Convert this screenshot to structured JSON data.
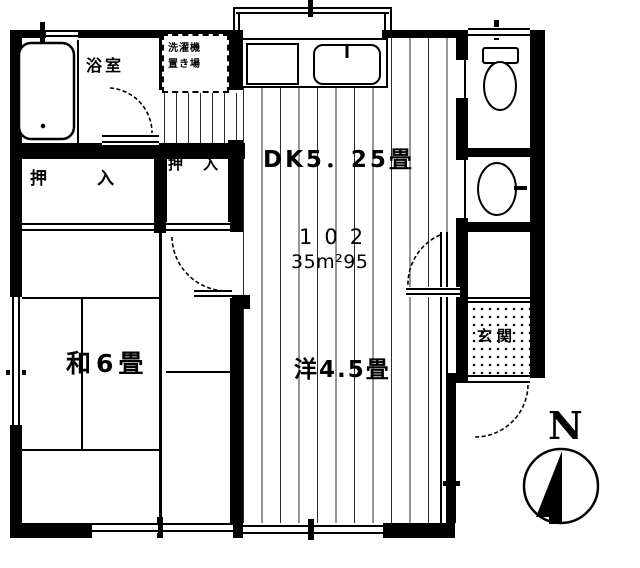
{
  "meta": {
    "drawing_type": "Japanese apartment floor plan",
    "ink_color": "#000000",
    "background_color": "#ffffff"
  },
  "unit": {
    "room_number": "102",
    "floor_area": "35m²95"
  },
  "rooms": {
    "dining_kitchen": {
      "label": "DK5．25畳"
    },
    "japanese_room": {
      "label": "和6畳"
    },
    "western_room": {
      "label": "洋4.5畳"
    },
    "bathroom": {
      "label": "浴室"
    },
    "entrance": {
      "label": "玄関"
    },
    "closet_left": {
      "label": "押入"
    },
    "closet_right": {
      "label": "押入"
    },
    "laundry_space": {
      "line1": "洗濯機",
      "line2": "置き場"
    }
  },
  "compass": {
    "north_label": "N"
  }
}
